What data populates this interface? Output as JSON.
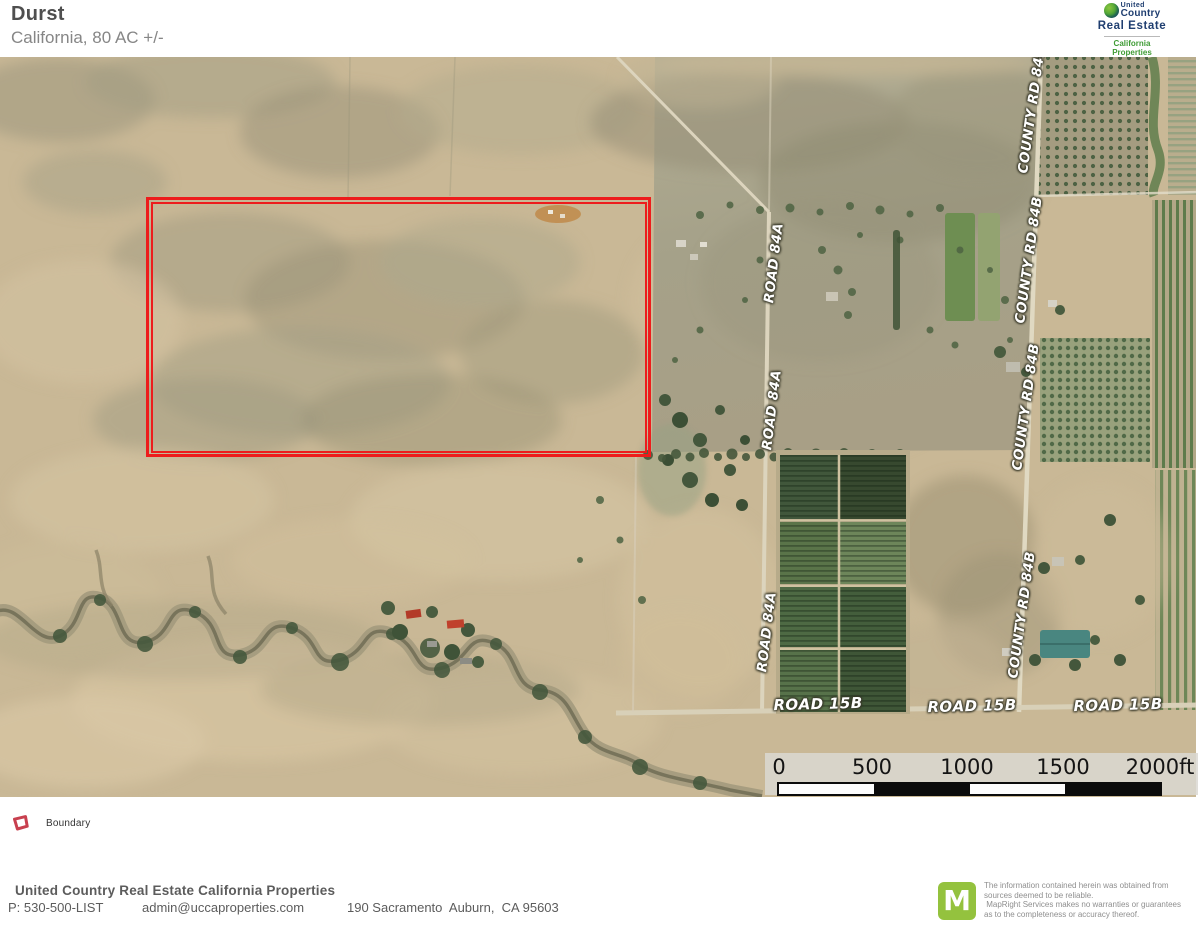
{
  "header": {
    "title": "Durst",
    "subtitle": "California, 80 AC +/-"
  },
  "brand": {
    "united": "United",
    "country": "Country",
    "real_estate": "Real Estate",
    "division": "California\nProperties"
  },
  "map": {
    "road_labels": [
      {
        "text": "COUNTY RD 84B"
      },
      {
        "text": "COUNTY RD 84B"
      },
      {
        "text": "COUNTY RD 84B"
      },
      {
        "text": "COUNTY RD 84B"
      },
      {
        "text": "ROAD 84A"
      },
      {
        "text": "ROAD 84A"
      },
      {
        "text": "ROAD 84A"
      },
      {
        "text": "ROAD 15B"
      },
      {
        "text": "ROAD 15B"
      },
      {
        "text": "ROAD 15B"
      }
    ],
    "scale_ticks": [
      "0",
      "500",
      "1000",
      "1500",
      "2000ft"
    ]
  },
  "legend": {
    "boundary_label": "Boundary"
  },
  "footer": {
    "company": "United Country Real Estate California Properties",
    "phone": "P: 530-500-LIST",
    "email": "admin@uccaproperties.com",
    "address": "190 Sacramento  Auburn,  CA 95603"
  },
  "attribution": {
    "logo_letter": "M",
    "disclaimer": "The information contained herein was obtained from\nsources deemed to be reliable.\n MapRight Services makes no warranties or guarantees\nas to the completeness or accuracy thereof."
  },
  "colors": {
    "boundary_stroke": "#ed1c1c",
    "legend_swatch": "#c8404f",
    "mapright_green": "#94c23e",
    "brand_navy": "#1f3e70",
    "brand_green": "#3f9c35"
  }
}
